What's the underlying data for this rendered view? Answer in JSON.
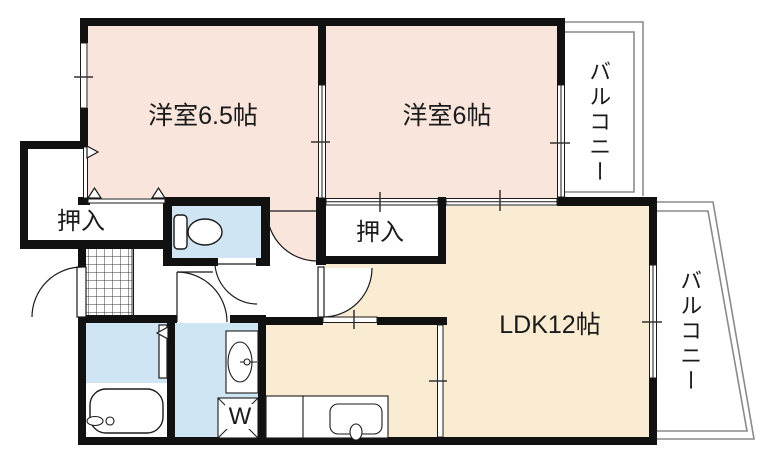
{
  "floorplan": {
    "labels": {
      "room1": "洋室6.5帖",
      "room2": "洋室6帖",
      "ldk": "LDK12帖",
      "closet_left": "押入",
      "closet_center": "押入",
      "balcony_top": "バルコニー",
      "balcony_right": "バルコニー",
      "washer": "W"
    },
    "colors": {
      "wall": "#111111",
      "bedroom_fill": "#f9e5dc",
      "ldk_fill": "#faecd2",
      "wet_area_fill": "#cfe5f4",
      "balcony_line": "#8a8a8a",
      "line": "#1a1a1a"
    }
  }
}
